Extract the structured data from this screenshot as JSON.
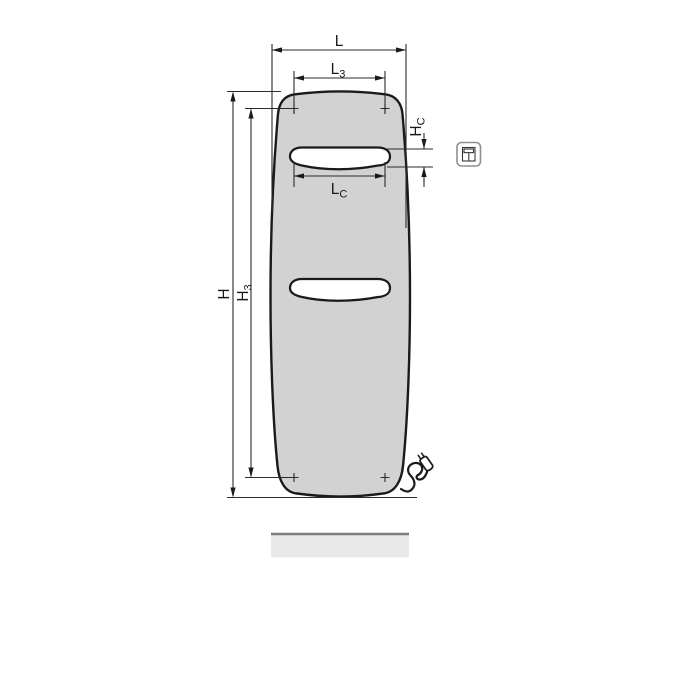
{
  "drawing": {
    "type": "technical-dimension-drawing",
    "subject": "flat panel radiator, front view, with power cable and plug",
    "labels": {
      "L": {
        "base": "L",
        "sub": ""
      },
      "L3": {
        "base": "L",
        "sub": "3"
      },
      "LC": {
        "base": "L",
        "sub": "C"
      },
      "H": {
        "base": "H",
        "sub": ""
      },
      "H3": {
        "base": "H",
        "sub": "3"
      },
      "HC": {
        "base": "H",
        "sub": "C"
      }
    },
    "colors": {
      "panel_fill": "#d2d2d2",
      "outline": "#1a1a1a",
      "dim_line": "#2b2b2b",
      "floor_fill": "#e9e9e9",
      "floor_edge": "#7d7d7d",
      "icon_border": "#8f8f8f",
      "background": "#ffffff"
    },
    "icon": {
      "name": "radiator-model-pictogram"
    }
  }
}
